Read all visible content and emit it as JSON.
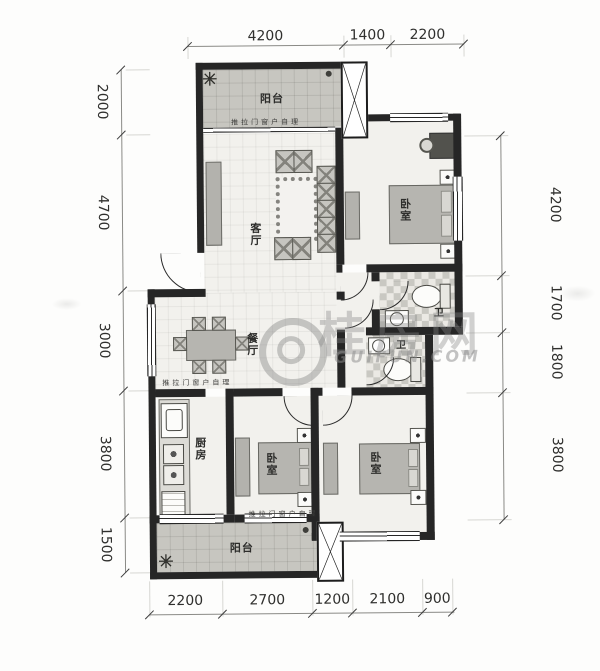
{
  "dimensions": {
    "top": [
      "4200",
      "1400",
      "2200"
    ],
    "left": [
      "2000",
      "4700",
      "3000",
      "3800",
      "1500"
    ],
    "right": [
      "4200",
      "1700",
      "1800",
      "3800"
    ],
    "bottom": [
      "2200",
      "2700",
      "1200",
      "2100",
      "900"
    ]
  },
  "rooms": {
    "balcony_top": "阳台",
    "living_room": "客厅",
    "master_bedroom": "卧室",
    "dining_room": "餐厅",
    "bathroom_upper": "卫",
    "bathroom_lower": "卫",
    "kitchen": "厨房",
    "bedroom_2": "卧室",
    "bedroom_3": "卧室",
    "balcony_bottom": "阳台"
  },
  "annotations": {
    "sliding_door_note": "推拉门窗户自理"
  },
  "watermark": {
    "brand": "桂房网",
    "site": "GUIFUN.COM"
  }
}
